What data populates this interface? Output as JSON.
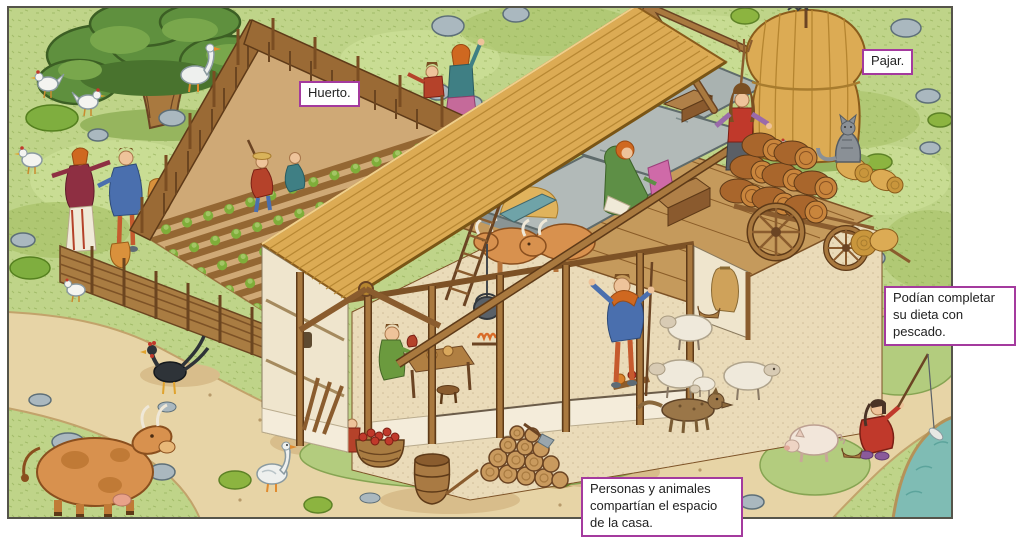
{
  "image": {
    "kind": "educational-illustration",
    "language": "es"
  },
  "labels": {
    "huerto": "Huerto.",
    "pajar": "Pajar.",
    "pescado": "Podían completar su dieta con pescado.",
    "casa": "Personas y animales compartían el espacio de la casa."
  },
  "palette": {
    "label_border": "#a43a9e",
    "label_bg": "#ffffff",
    "label_text": "#222222",
    "grass": "#bfd489",
    "path_sand": "#e7d4a6",
    "river": "#7fbcb4",
    "thatch": "#dcab54",
    "timber": "#8a5c2e",
    "plaster": "#efe5cd",
    "stone": "#b2bab8",
    "cattle": "#d8914e",
    "tree": "#5f903e"
  },
  "scene": {
    "elements": [
      "oak-tree",
      "chickens",
      "goose",
      "wattle-fence",
      "palisade-fence",
      "vegetable-garden",
      "garden-workers",
      "pointing-couple",
      "timber-framed-house",
      "thatched-roof",
      "stone-slabs",
      "hay-loft",
      "loft-woman-with-chest",
      "ladder",
      "cattle-stall",
      "cooking-pot",
      "dining-table",
      "haystack",
      "hay-worker",
      "hay-cart",
      "barrels",
      "hay-bales",
      "cat",
      "sheep",
      "lamb",
      "dog",
      "shepherd",
      "rooster",
      "cow",
      "pig",
      "firewood-pile",
      "barrel",
      "apple-basket",
      "goose-on-path",
      "sandy-path",
      "river",
      "fisherman",
      "rocks",
      "moss-rocks"
    ]
  }
}
